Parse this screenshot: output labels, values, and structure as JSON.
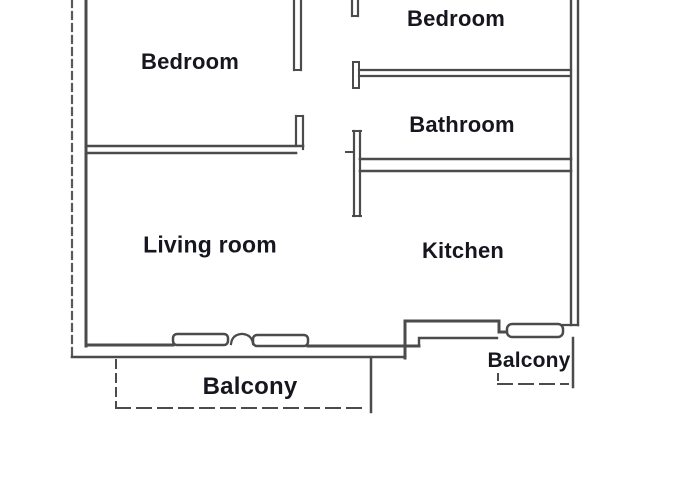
{
  "plan": {
    "title": "Apartment floor plan",
    "rooms": {
      "bedroom_left": "Bedroom",
      "bedroom_right": "Bedroom",
      "bathroom": "Bathroom",
      "living_room": "Living room",
      "kitchen": "Kitchen",
      "balcony_left": "Balcony",
      "balcony_right": "Balcony"
    },
    "colors": {
      "wall": "#4b4b4b",
      "wall_light": "#5a5a5a",
      "label_text": "#16161f",
      "background": "#ffffff"
    }
  }
}
